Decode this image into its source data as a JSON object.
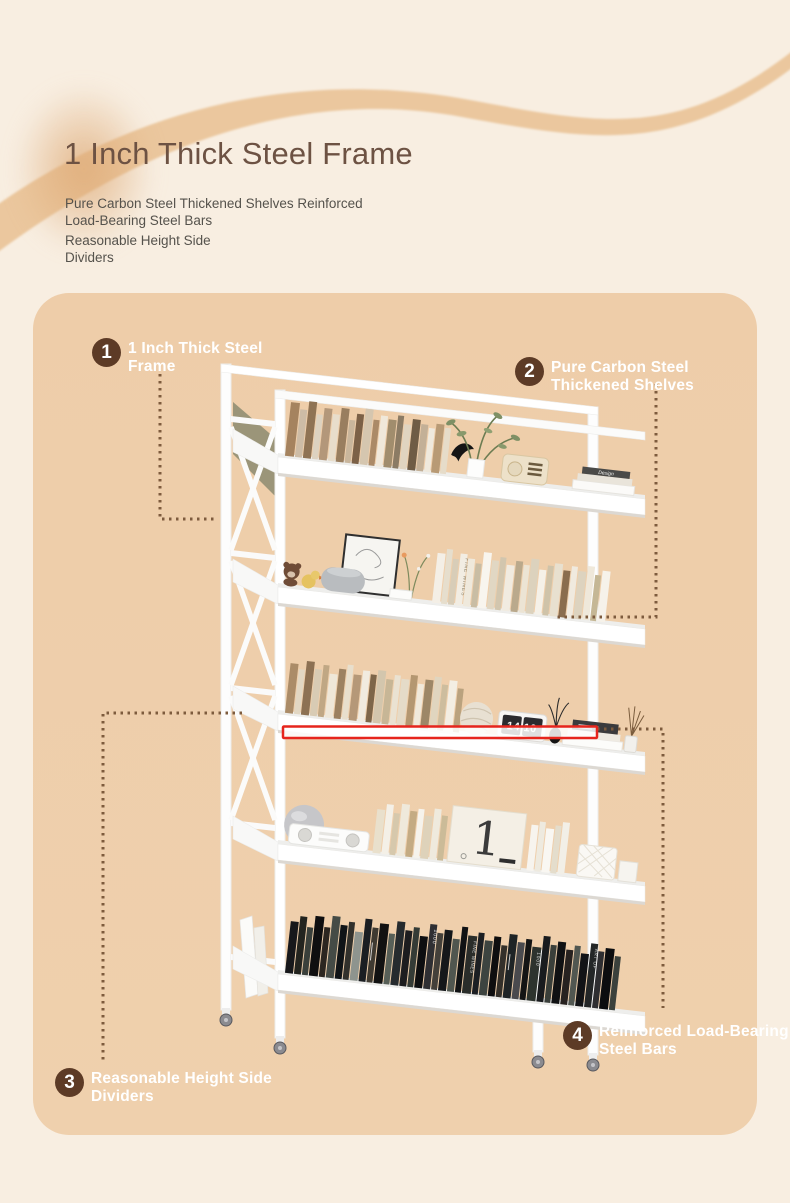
{
  "page": {
    "background_color": "#f8eee1",
    "panel_color": "#eecda9",
    "swirl_color": "#ebc79e",
    "dotted_line_color": "#7d5b3d",
    "highlight_color": "#e6251d",
    "badge_color": "#5d3b26",
    "title_color": "#6d5243"
  },
  "header": {
    "title": "1 Inch Thick Steel Frame",
    "subtitle_para1": "Pure Carbon Steel Thickened Shelves Reinforced\nLoad-Bearing Steel Bars",
    "subtitle_para2": "Reasonable Height Side\nDividers"
  },
  "callouts": [
    {
      "number": "1",
      "label": "1 Inch Thick Steel\nFrame"
    },
    {
      "number": "2",
      "label": "Pure Carbon Steel\nThickened Shelves"
    },
    {
      "number": "3",
      "label": "Reasonable Height Side\nDividers"
    },
    {
      "number": "4",
      "label": "Reinforced Load-Bearing\nSteel Bars"
    }
  ],
  "photo": {
    "clock_display": "14 10",
    "poster_numeral": "1",
    "stack_spine_text": "Design",
    "spine_text_fine_wines": "FINE WINES",
    "spine_text_1000": "1000",
    "spine_text_art": "ART OF"
  }
}
